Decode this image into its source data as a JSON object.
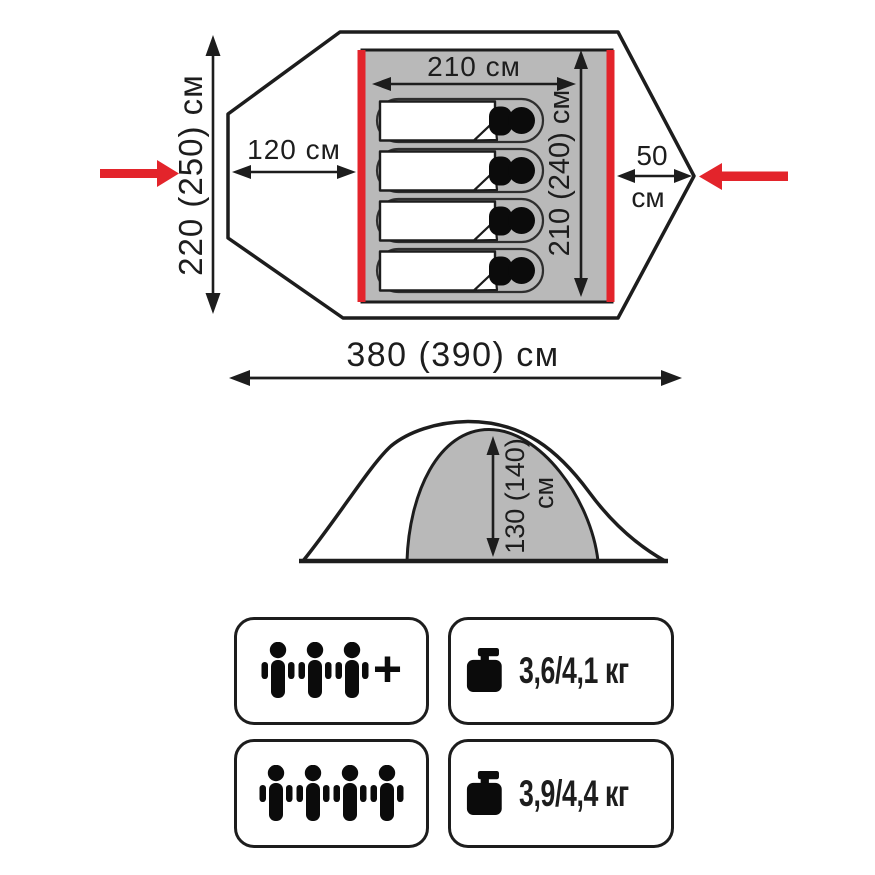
{
  "top_view": {
    "inner_width_label": "210 см",
    "inner_depth_label": "210 (240) см",
    "left_vestibule_label": "120 см",
    "right_vestibule_value": "50",
    "right_vestibule_unit": "см",
    "total_width_label": "220 (250) см",
    "total_length_label": "380 (390) см",
    "sleeping_places": 4
  },
  "side_view": {
    "height_value": "130 (140)",
    "height_unit": "см"
  },
  "specs": {
    "capacity_primary": {
      "persons": 3,
      "plus": "+"
    },
    "weight_primary": {
      "label": "3,6/4,1 кг"
    },
    "capacity_max": {
      "persons": 4
    },
    "weight_max": {
      "label": "3,9/4,4 кг"
    }
  },
  "icons": {
    "capacity": "person-icon",
    "weight": "weight-icon",
    "entrance_marker": "red-entrance-arrow-icon",
    "sleeper": "sleeping-bag-icon"
  },
  "colors": {
    "accent_red": "#e3242b",
    "diagram_gray": "#b9b9b9",
    "line_dark": "#1d1d1d"
  }
}
